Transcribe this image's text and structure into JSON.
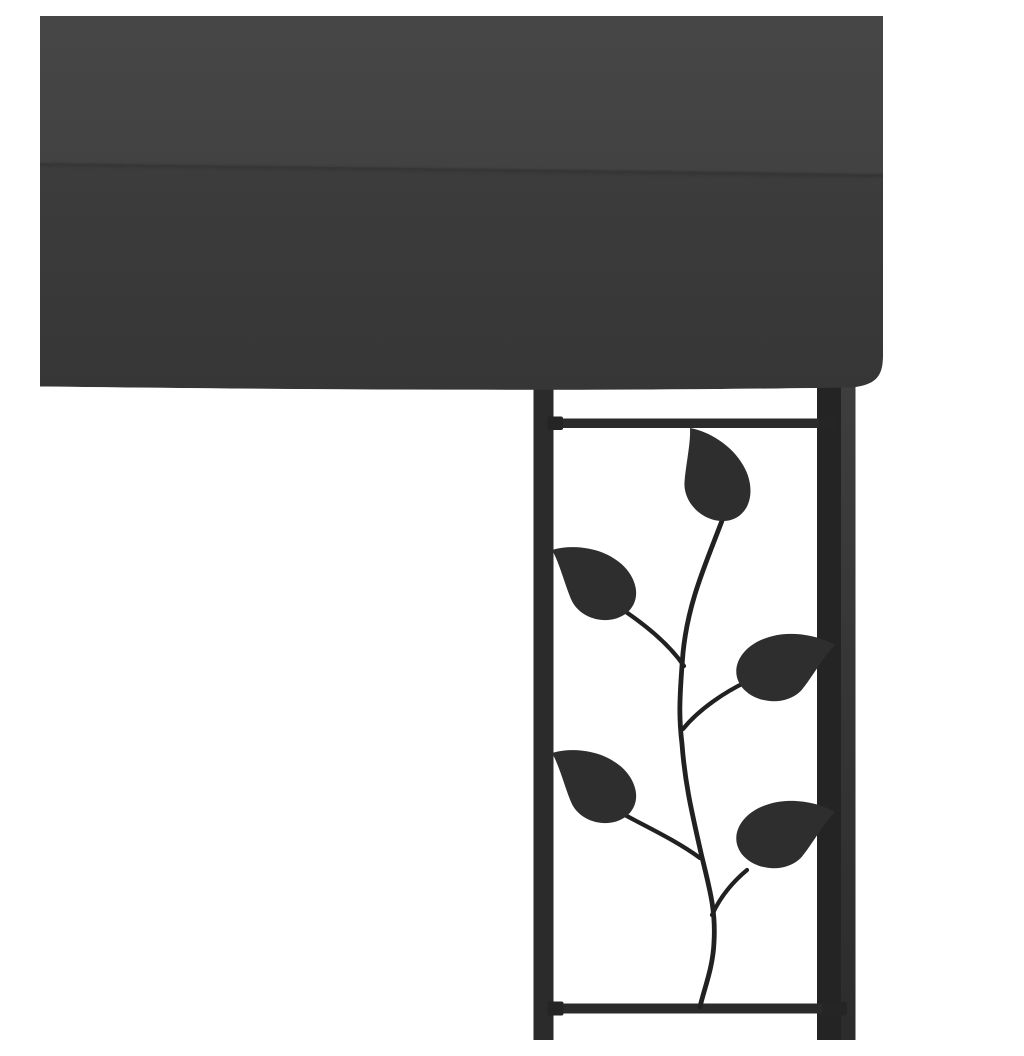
{
  "scene": {
    "kind": "product-photo",
    "subject": "Corner of a wall-mounted gazebo: dark anthracite fabric canopy above a black powder-coated steel post with decorative leaf-vine trellis panel",
    "background": "plain white studio background",
    "visible_text": ""
  },
  "colors": {
    "background": "#ffffff",
    "canopy_roof_top": "#464646",
    "canopy_roof_bottom": "#424242",
    "canopy_valance_top": "#3c3c3c",
    "canopy_valance_bottom": "#363636",
    "canopy_seam": "#2d2d2d",
    "left_post": "#2b2b2b",
    "right_post_front": "#242424",
    "right_post_side_top": "#3e3e3e",
    "right_post_side_bottom": "#2c2c2c",
    "crossbar": "#2b2b2b",
    "crossbar_cap": "#252525",
    "stem": "#212121",
    "leaf": "#2e2e2e"
  },
  "elements": {
    "canopy": "anthracite canopy with roof panel, horizontal seam and hanging valance",
    "left_upright": "thin black trellis upright under canopy",
    "right_upright": "square black corner post under canopy",
    "top_crossbar": "horizontal rail below canopy",
    "bottom_crossbar": "horizontal rail near image bottom",
    "vine": "curved metal vine stem with five teardrop leaves"
  }
}
